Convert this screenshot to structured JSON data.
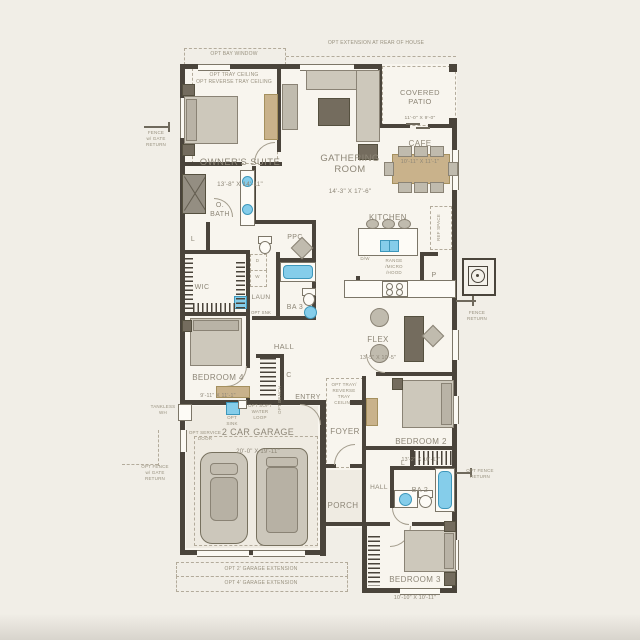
{
  "colors": {
    "wall": "#4a443b",
    "fixture_blue": "#85cdea",
    "furniture_tan": "#c9b28b",
    "label_text": "#8d8677",
    "background": "#f1eee7"
  },
  "rooms": {
    "owners_suite": {
      "name": "OWNER'S SUITE",
      "dims": "13'-8\" X 14'-11\""
    },
    "gathering_room": {
      "name": "GATHERING\nROOM",
      "dims": "14'-3\" X 17'-6\""
    },
    "covered_patio": {
      "name": "COVERED\nPATIO",
      "dims": "11'-0\" X 9'-0\""
    },
    "cafe": {
      "name": "CAFE",
      "dims": "10'-11\" X 11'-1\""
    },
    "kitchen": {
      "name": "KITCHEN"
    },
    "owners_bath": {
      "name": "O.\nBATH"
    },
    "wic": {
      "name": "WIC"
    },
    "laundry": {
      "name": "LAUN",
      "note": "OPT SNK"
    },
    "ppc": {
      "name": "PPC"
    },
    "bath3": {
      "name": "BA 3"
    },
    "hall_upper": {
      "name": "HALL"
    },
    "flex": {
      "name": "FLEX",
      "dims": "13'-5\" X 10'-5\""
    },
    "bedroom4": {
      "name": "BEDROOM 4",
      "dims": "9'-11\" X 11'-1\""
    },
    "entry": {
      "name": "ENTRY"
    },
    "foyer": {
      "name": "FOYER"
    },
    "bedroom2": {
      "name": "BEDROOM 2",
      "dims": "13'-2\" X 10'-11\""
    },
    "garage": {
      "name": "2 CAR GARAGE",
      "dims": "20'-0\" X 19'-11\""
    },
    "porch": {
      "name": "PORCH"
    },
    "hall_lower": {
      "name": "HALL"
    },
    "bath2": {
      "name": "BA 2"
    },
    "bedroom3": {
      "name": "BEDROOM 3",
      "dims": "10'-10\" X 10'-11\""
    },
    "closet_linen_bath": {
      "name": "L"
    },
    "closet_entry": {
      "name": "C"
    },
    "closet_linen_hall": {
      "name": "L"
    },
    "pantry": {
      "name": "P"
    }
  },
  "options": {
    "rear_extension": "OPT EXTENSION AT REAR OF HOUSE",
    "bay_window": "OPT BAY WINDOW",
    "tray_suite": "OPT TRAY CEILING\nOPT REVERSE TRAY CEILING",
    "tray_foyer": "OPT TRAY/\nREVERSE TRAY\nCEILING",
    "garage_ext_2": "OPT 2' GARAGE EXTENSION",
    "garage_ext_4": "OPT 4' GARAGE EXTENSION",
    "service_door": "OPT SERVICE\nDOOR",
    "garage_sink": "OPT\nSINK",
    "soft_water": "OPT SOFT\nWATER\nLOOP",
    "bench": "OPT BENCH",
    "fence_gate_top": "FENCE\nw/ GATE\nRETURN",
    "fence_gate_bottom": "OPT FENCE\nw/ GATE\nRETURN",
    "fence_return": "FENCE\nRETURN",
    "opt_fence_return": "OPT FENCE\nRETURN",
    "tankless": "TANKLESS\nWH"
  },
  "appliances": {
    "dishwasher": "D/W",
    "range_stack": "RANGE\n/MICRO\n/HOOD",
    "ref": "REF SPACE",
    "dryer": "D",
    "washer": "W"
  }
}
